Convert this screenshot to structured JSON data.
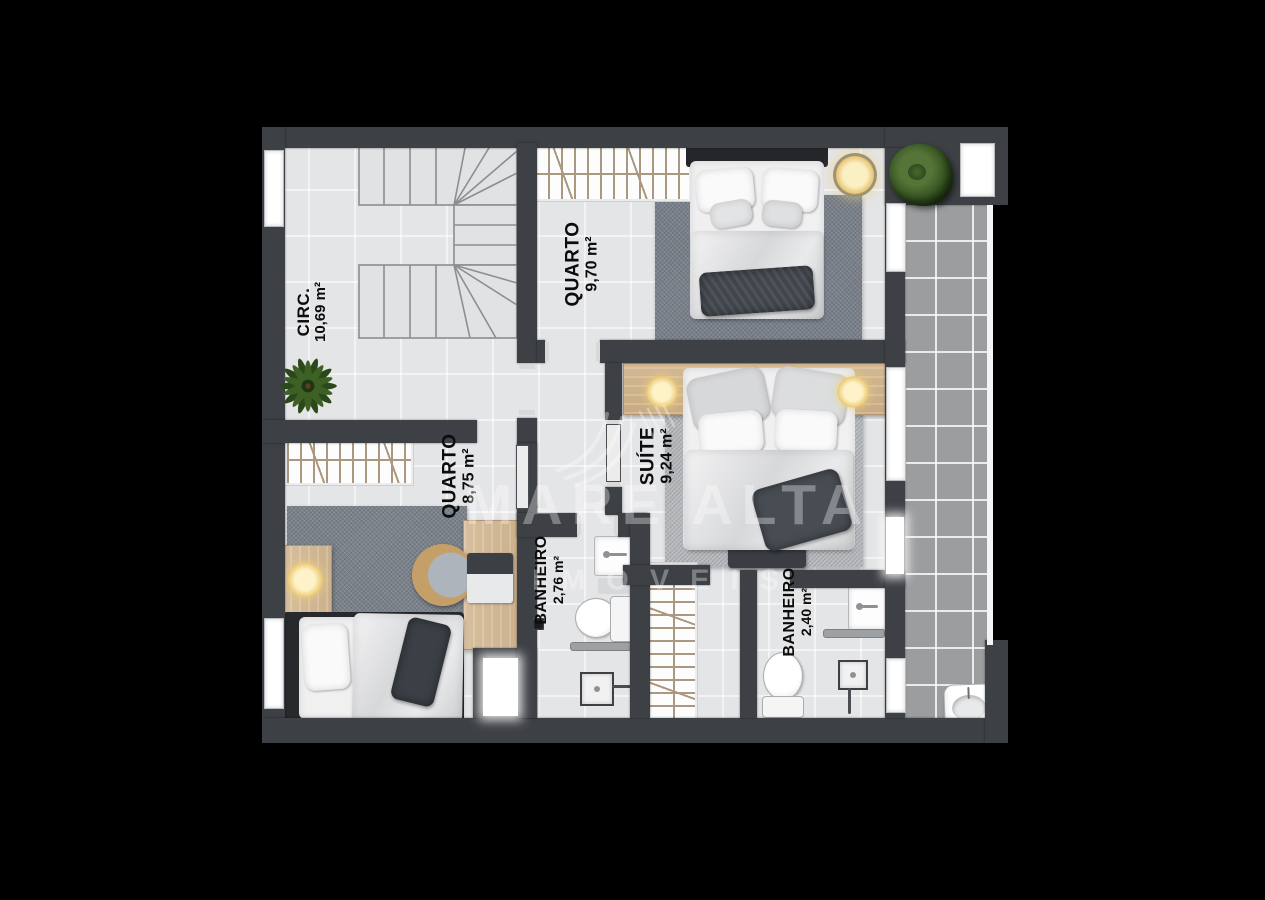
{
  "document": {
    "type": "floor-plan",
    "floor": "upper-level"
  },
  "watermark": {
    "brand": "MARE ALTA",
    "subtitle": "IMÓVEIS"
  },
  "rooms": [
    {
      "name": "CIRC.",
      "area": "10,69 m²"
    },
    {
      "name": "QUARTO",
      "area": "9,70 m²"
    },
    {
      "name": "SUÍTE",
      "area": "9,24 m²"
    },
    {
      "name": "QUARTO",
      "area": "8,75 m²"
    },
    {
      "name": "BANHEIRO",
      "area": "2,76 m²"
    },
    {
      "name": "BANHEIRO",
      "area": "2,40 m²"
    }
  ],
  "colors": {
    "background": "#000000",
    "wall": "#3d4045",
    "floor": "#e4e5e7",
    "terrace": "#9c9d9f",
    "wood": "#d5bb97",
    "closet_hatch": "#ab9880",
    "lamp_glow": "#f0d28a",
    "plant_green": "#33511f",
    "label_text": "#0c0c0c",
    "watermark": "#ffffff"
  }
}
